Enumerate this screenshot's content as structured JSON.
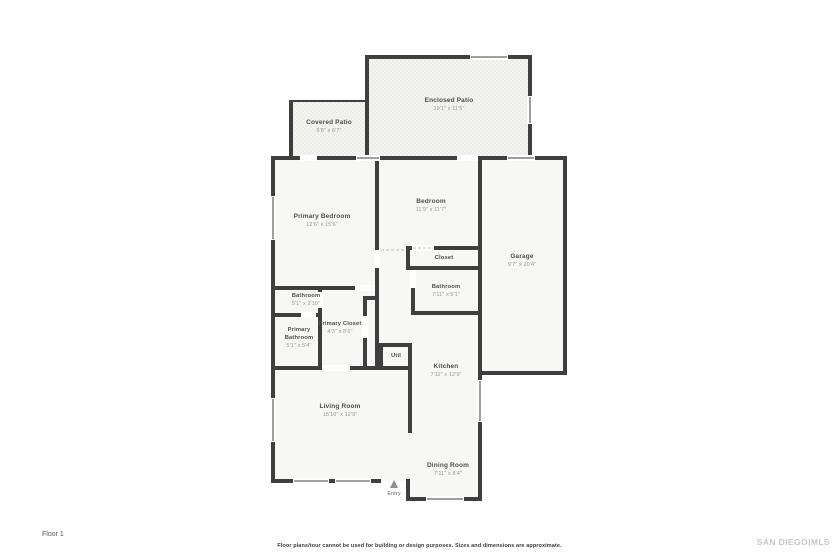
{
  "meta": {
    "floor_label": "Floor 1",
    "disclaimer": "Floor plans/tour cannot be used for building or design purposes. Sizes and dimensions are approximate.",
    "watermark": "SAN DIEGO|MLS"
  },
  "colors": {
    "wall": "#3f3f3f",
    "roomfill": "#f7f7f5",
    "patiofill": "#f4f4f1",
    "patiodot": "#e2e2dc",
    "label": "#4e4e4e",
    "dim": "#979797",
    "dash": "#bdbdbd",
    "arrow": "#8f8f8f",
    "watermark": "#c7c7c7"
  },
  "rooms": {
    "enclosed_patio": {
      "name": "Enclosed Patio",
      "dims": "19'1\" x 11'5\""
    },
    "covered_patio": {
      "name": "Covered Patio",
      "dims": "9'8\" x 6'7\""
    },
    "primary_bedroom": {
      "name": "Primary Bedroom",
      "dims": "12'6\" x 15'6\""
    },
    "bedroom": {
      "name": "Bedroom",
      "dims": "11'9\" x 11'7\""
    },
    "closet": {
      "name": "Closet"
    },
    "bathroom": {
      "name": "Bathroom",
      "dims": "7'11\" x 5'1\""
    },
    "hall_bathroom": {
      "name": "Bathroom",
      "dims": "5'1\" x 2'10\""
    },
    "primary_bathroom": {
      "name": "Primary Bathroom",
      "dims": "5'1\" x 5'4\""
    },
    "primary_closet": {
      "name": "Primary Closet",
      "dims": "4'3\" x 8'6\""
    },
    "util": {
      "name": "Util"
    },
    "kitchen": {
      "name": "Kitchen",
      "dims": "7'11\" x 12'9\""
    },
    "living_room": {
      "name": "Living Room",
      "dims": "15'10\" x 12'9\""
    },
    "dining_room": {
      "name": "Dining Room",
      "dims": "7'11\" x 8'4\""
    },
    "garage": {
      "name": "Garage",
      "dims": "9'7\" x 20'4\""
    },
    "entry": {
      "name": "Entry"
    }
  }
}
